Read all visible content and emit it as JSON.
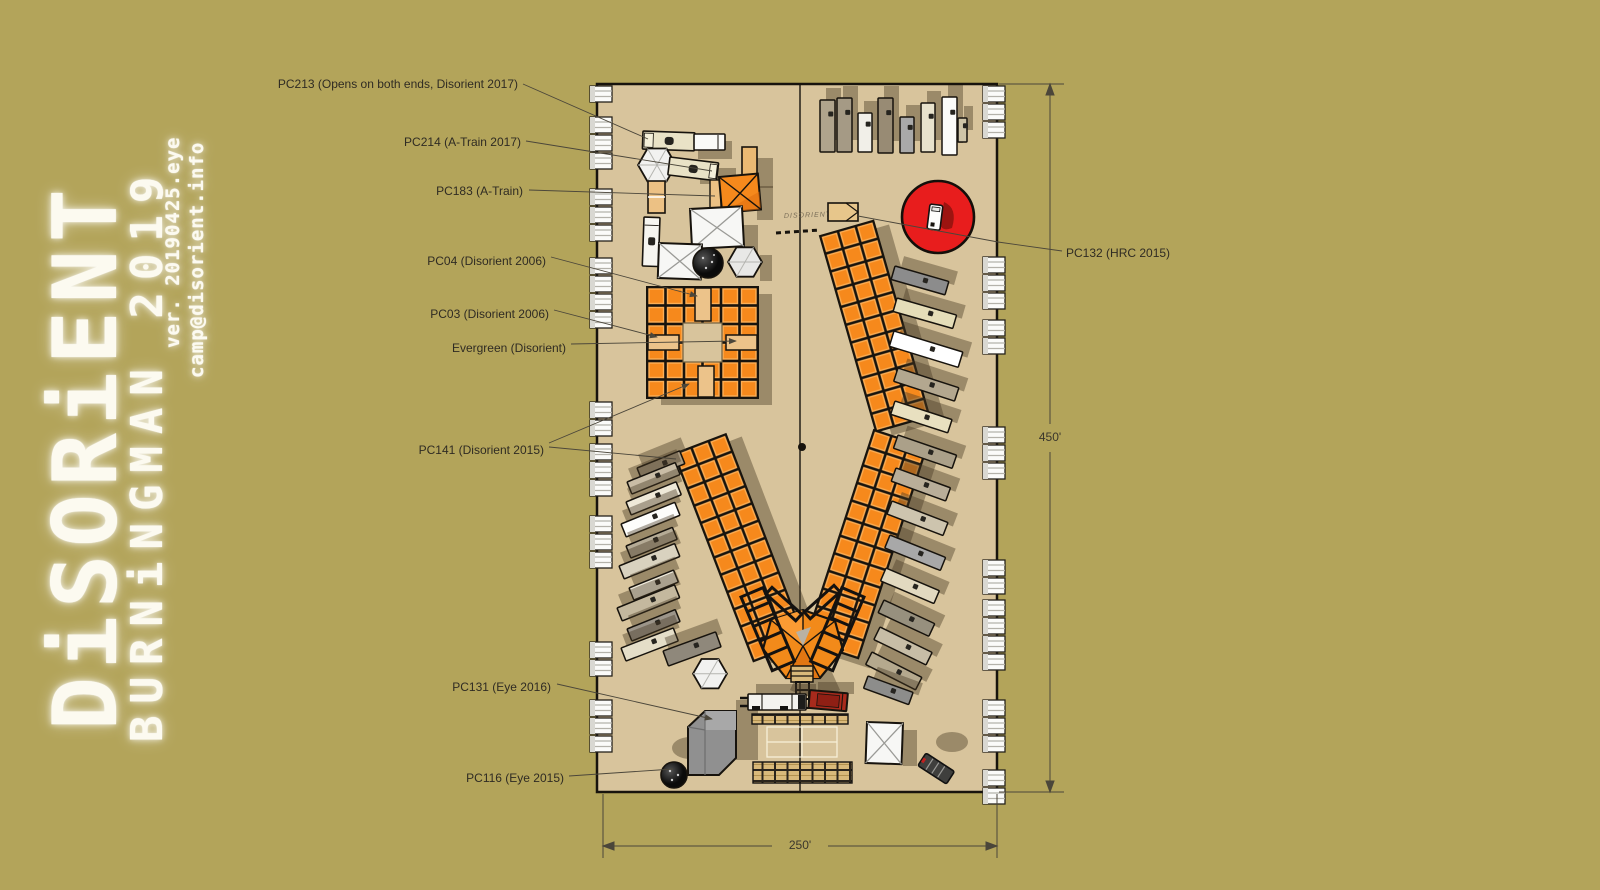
{
  "branding": {
    "title": "DiSORiENT",
    "subtitle": "BURNiNGMAN 2019",
    "version": "ver. 20190425.eye",
    "email": "camp@disorient.info"
  },
  "labels": {
    "pc213": "PC213 (Opens on both ends, Disorient 2017)",
    "pc214": "PC214 (A-Train 2017)",
    "pc183": "PC183 (A-Train)",
    "pc04": "PC04 (Disorient 2006)",
    "pc03": "PC03 (Disorient 2006)",
    "evergreen": "Evergreen (Disorient)",
    "pc141": "PC141 (Disorient 2015)",
    "pc131": "PC131 (Eye 2016)",
    "pc116": "PC116 (Eye 2015)",
    "pc132": "PC132 (HRC 2015)"
  },
  "dimensions": {
    "height": "450'",
    "width": "250'"
  },
  "plan": {
    "ground_sign": "DISORIENT"
  }
}
